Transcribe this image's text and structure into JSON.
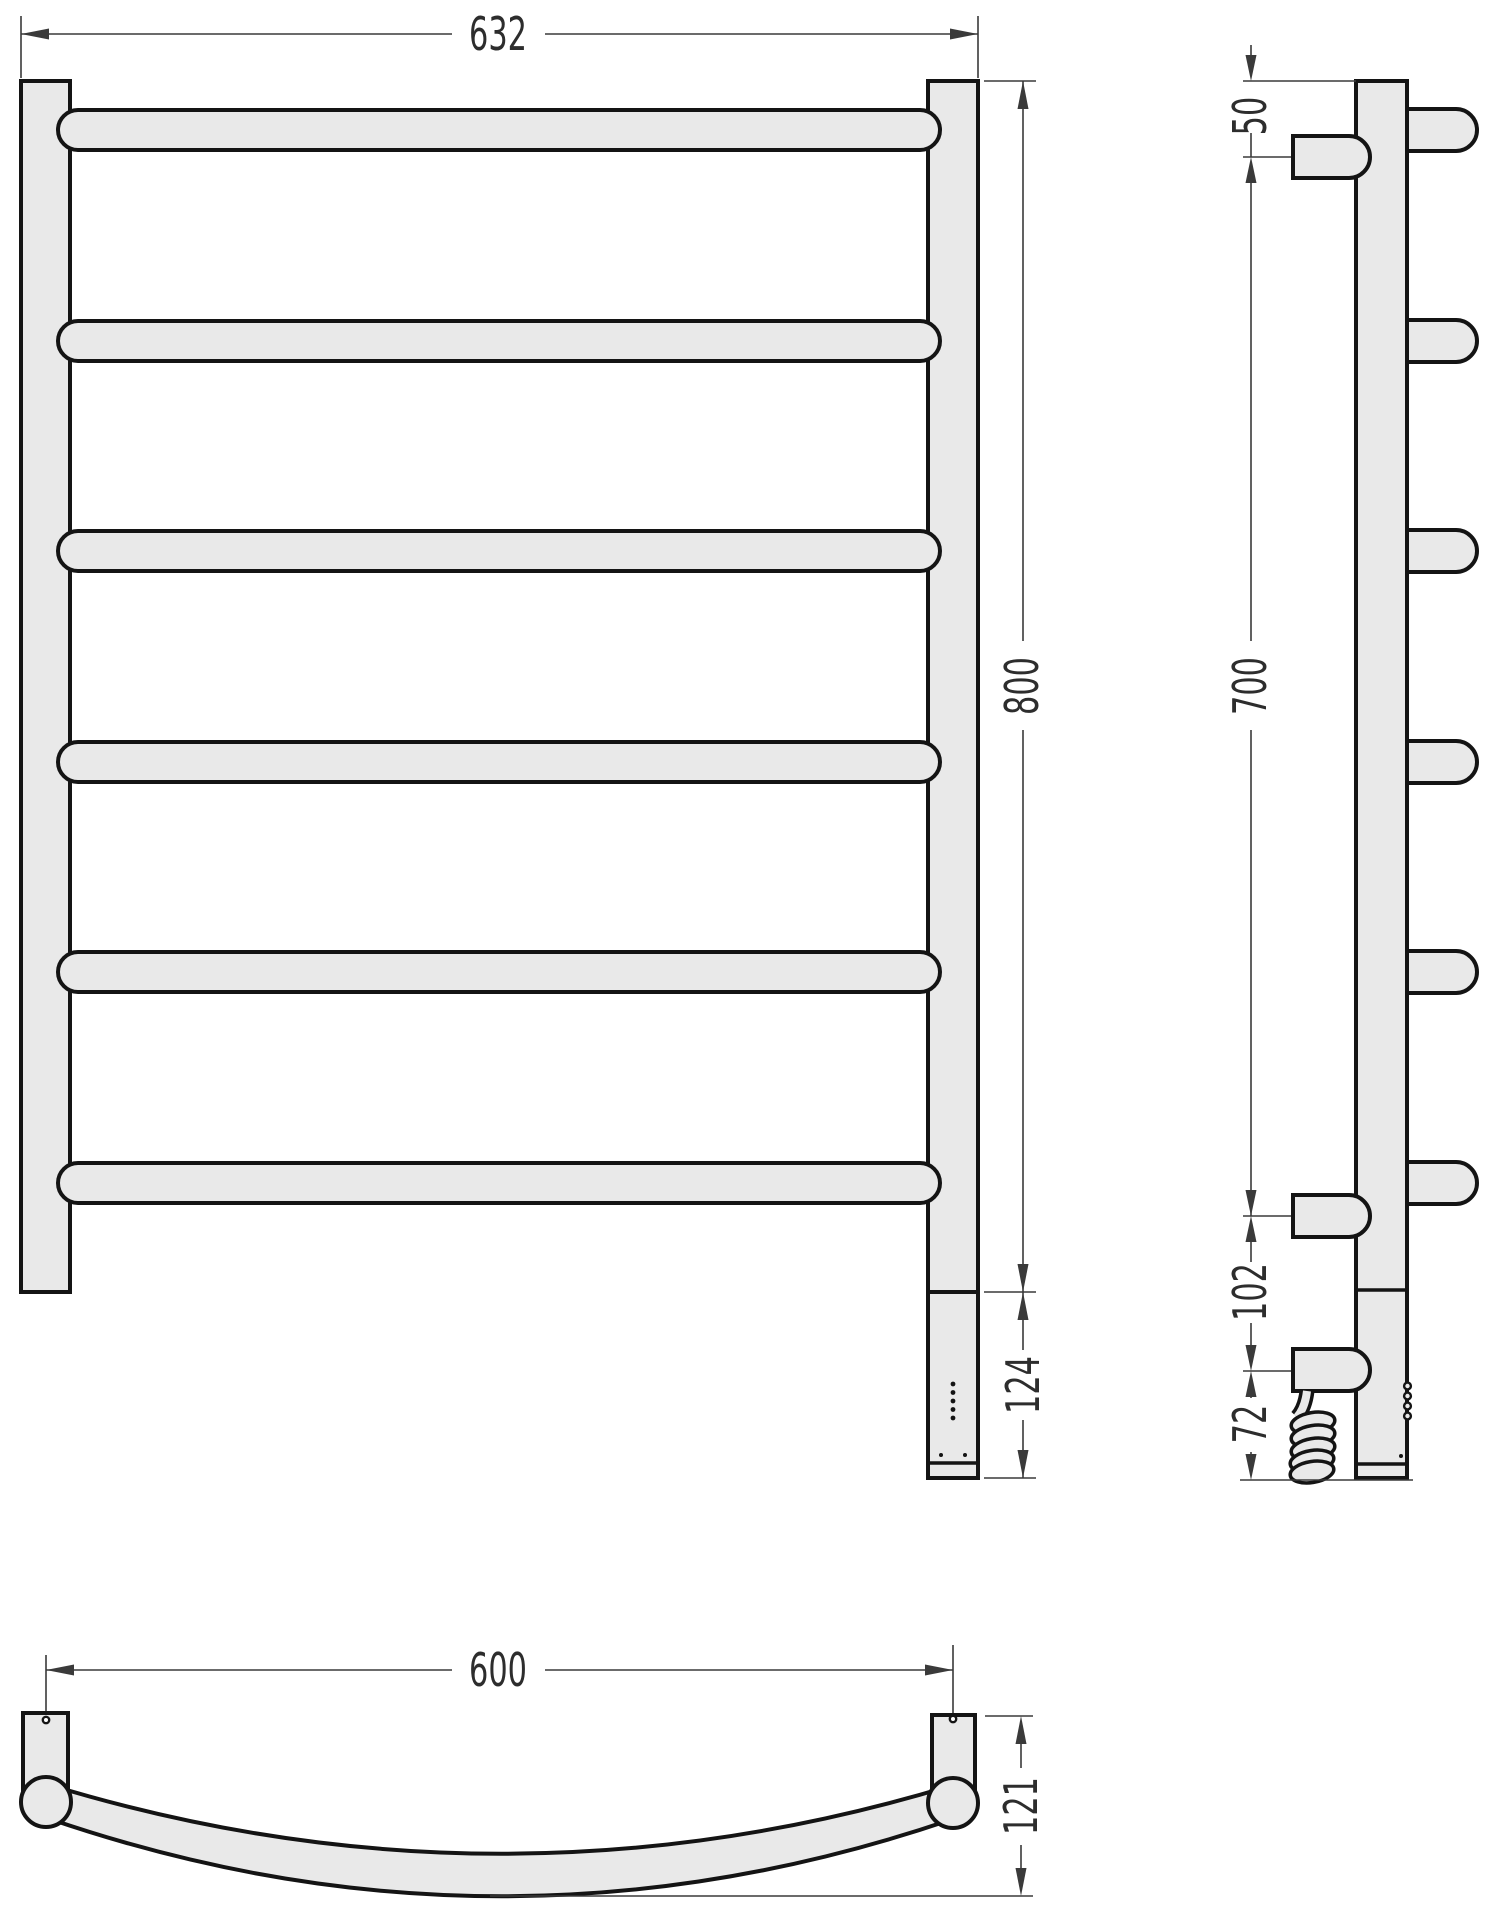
{
  "drawing": {
    "type": "technical-dimension-drawing",
    "views": {
      "front": "front view",
      "side": "side view",
      "bottom": "bottom view"
    },
    "dimensions": {
      "front_width": "632",
      "front_height": "800",
      "front_bottom_section": "124",
      "side_top_offset": "50",
      "side_rung_span": "700",
      "side_connector_gap": "102",
      "side_cable_drop": "72",
      "bottom_mount_spacing": "600",
      "bottom_depth": "121"
    },
    "colors": {
      "fill": "#e9e9e9",
      "outline": "#141414",
      "dim_line": "#3a3a3a",
      "text": "#2d2d2d",
      "background": "#ffffff"
    }
  }
}
